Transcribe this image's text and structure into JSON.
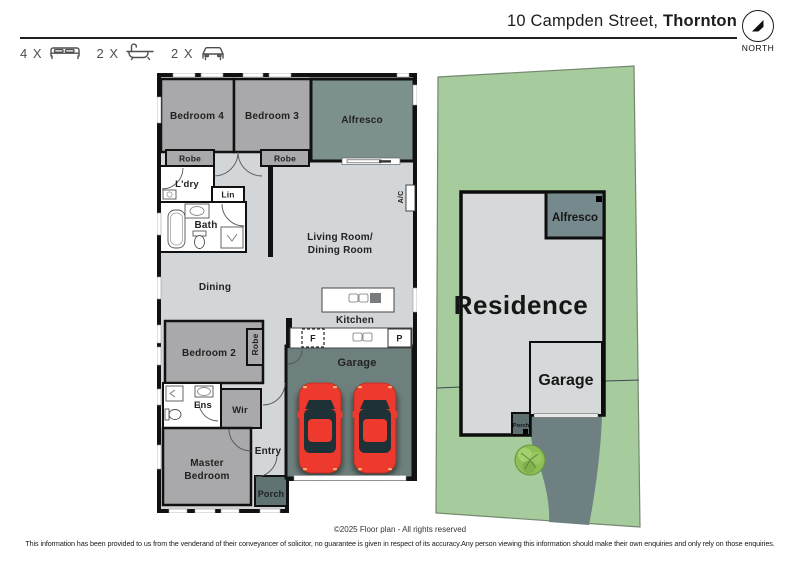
{
  "header": {
    "address_normal": "10 Campden Street, ",
    "address_bold": "Thornton",
    "stats": [
      {
        "count": "4 X",
        "icon": "bed-icon"
      },
      {
        "count": "2 X",
        "icon": "bath-icon"
      },
      {
        "count": "2 X",
        "icon": "car-icon"
      }
    ],
    "north_label": "NORTH"
  },
  "floor_plan": {
    "rooms": {
      "bedroom4": "Bedroom 4",
      "bedroom3": "Bedroom 3",
      "alfresco": "Alfresco",
      "robe4": "Robe",
      "robe3": "Robe",
      "laundry": "L'dry",
      "linen": "Lin",
      "bath": "Bath",
      "living_line1": "Living Room/",
      "living_line2": "Dining Room",
      "dining": "Dining",
      "kitchen": "Kitchen",
      "fridge": "F",
      "pantry": "P",
      "ac": "A/C",
      "bedroom2": "Bedroom 2",
      "robe2": "Robe",
      "ensuite": "Ens",
      "wir": "Wir",
      "master_line1": "Master",
      "master_line2": "Bedroom",
      "entry": "Entry",
      "porch": "Porch",
      "garage": "Garage"
    }
  },
  "site_plan": {
    "residence": "Residence",
    "alfresco": "Alfresco",
    "garage": "Garage",
    "porch": "Porch"
  },
  "footer": {
    "copyright": "©2025 Floor plan  - All rights reserved",
    "disclaimer": "This information has been provided to us from the venderand of their conveyancer of solicitor, no guarantee is given in respect of its accuracy.Any person viewing this information should make their own enquiries and only rely on those enquiries."
  },
  "colors": {
    "wall": "#111111",
    "floor_light": "#d3d6d8",
    "room_gray": "#a9a9ab",
    "plan_alfresco": "#7c908d",
    "plan_garage": "#6d807d",
    "plan_porch": "#5f7372",
    "car_red": "#ee392e",
    "car_glass": "#1d3136",
    "lot_green": "#a6cb9d",
    "site_residence": "#d6d9da",
    "site_alfresco": "#76898c",
    "site_driveway": "#6e8081",
    "tree_green": "#8dbf57"
  }
}
